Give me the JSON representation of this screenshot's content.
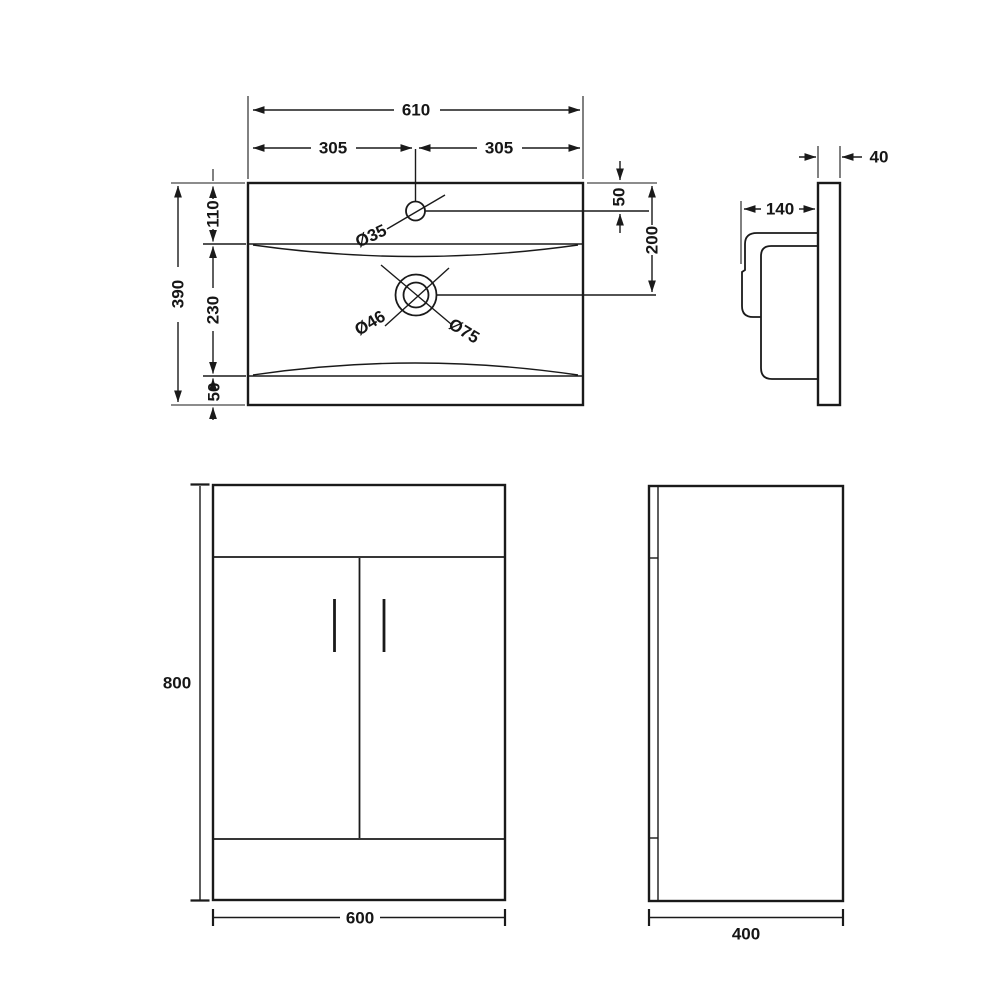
{
  "drawing": {
    "background": "#ffffff",
    "line_color": "#1a1a1a",
    "views": {
      "basin_plan": {
        "name": "basin plan view",
        "dim_width_total": "610",
        "dim_width_left_half": "305",
        "dim_width_right_half": "305",
        "dim_depth_total": "390",
        "dim_depth_front": "110",
        "dim_depth_middle": "230",
        "dim_depth_back": "50",
        "dim_tap_hole_offset": "50",
        "dim_waste_offset": "200",
        "label_tap_hole_dia": "Ø35",
        "label_waste_inner_dia": "Ø46",
        "label_waste_outer_dia": "Ø75"
      },
      "basin_side": {
        "name": "basin side view",
        "dim_panel_thickness": "40",
        "dim_bowl_depth": "140"
      },
      "cabinet_front": {
        "name": "cabinet front view",
        "dim_height": "800",
        "dim_width": "600"
      },
      "cabinet_side": {
        "name": "cabinet side view",
        "dim_depth": "400"
      }
    }
  }
}
